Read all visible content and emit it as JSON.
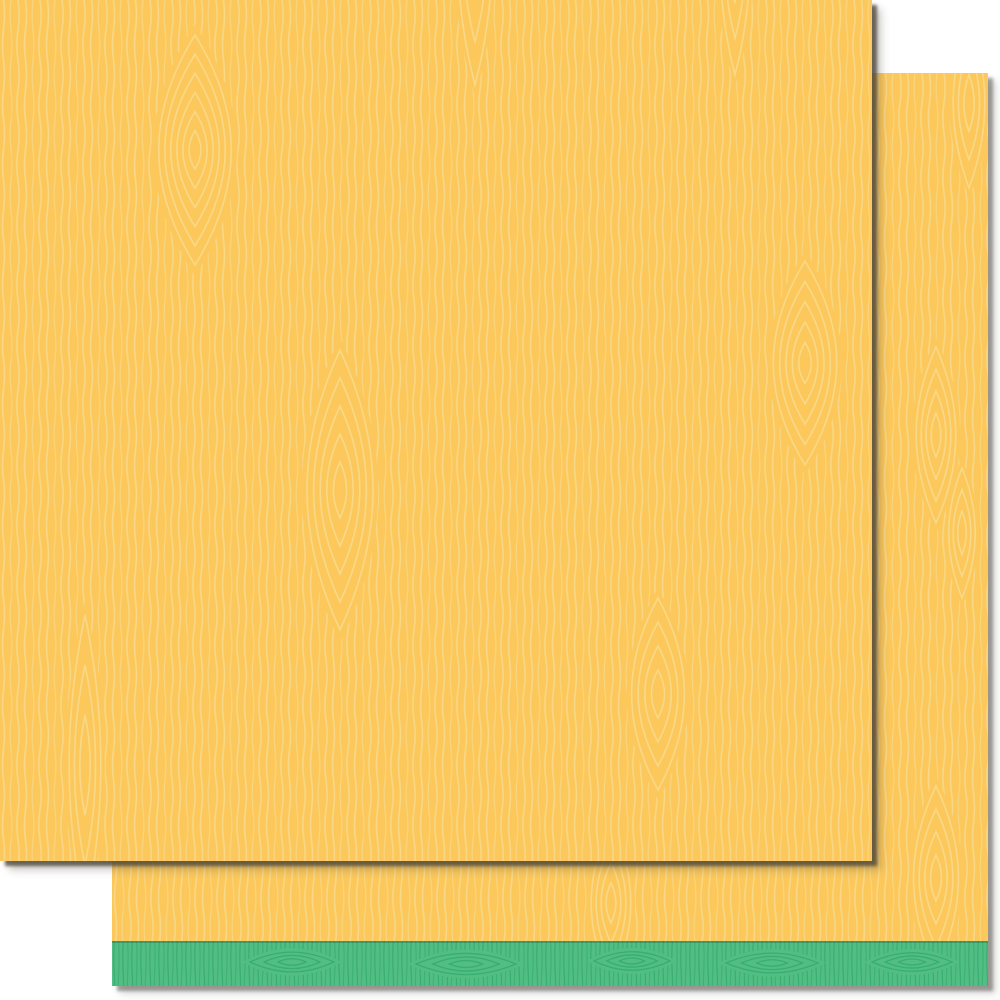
{
  "page": {
    "backdrop_color": "#ffffff"
  },
  "product": {
    "front_sheet": {
      "kind": "woodgrain paper sheet, front",
      "base_color": "#FCC85C",
      "grain_line_color": "#F8DA8C"
    },
    "back_sheet": {
      "kind": "woodgrain paper sheet, back, with accent strip",
      "base_color": "#FCC85C",
      "grain_line_color": "#F8DA8C",
      "strip_color": "#53BE84",
      "strip_grain_line_color": "#35AC6E",
      "strip_edge_line_color": "rgba(23, 94, 56, 0.35)"
    },
    "shadow_color": "#6B655A"
  }
}
